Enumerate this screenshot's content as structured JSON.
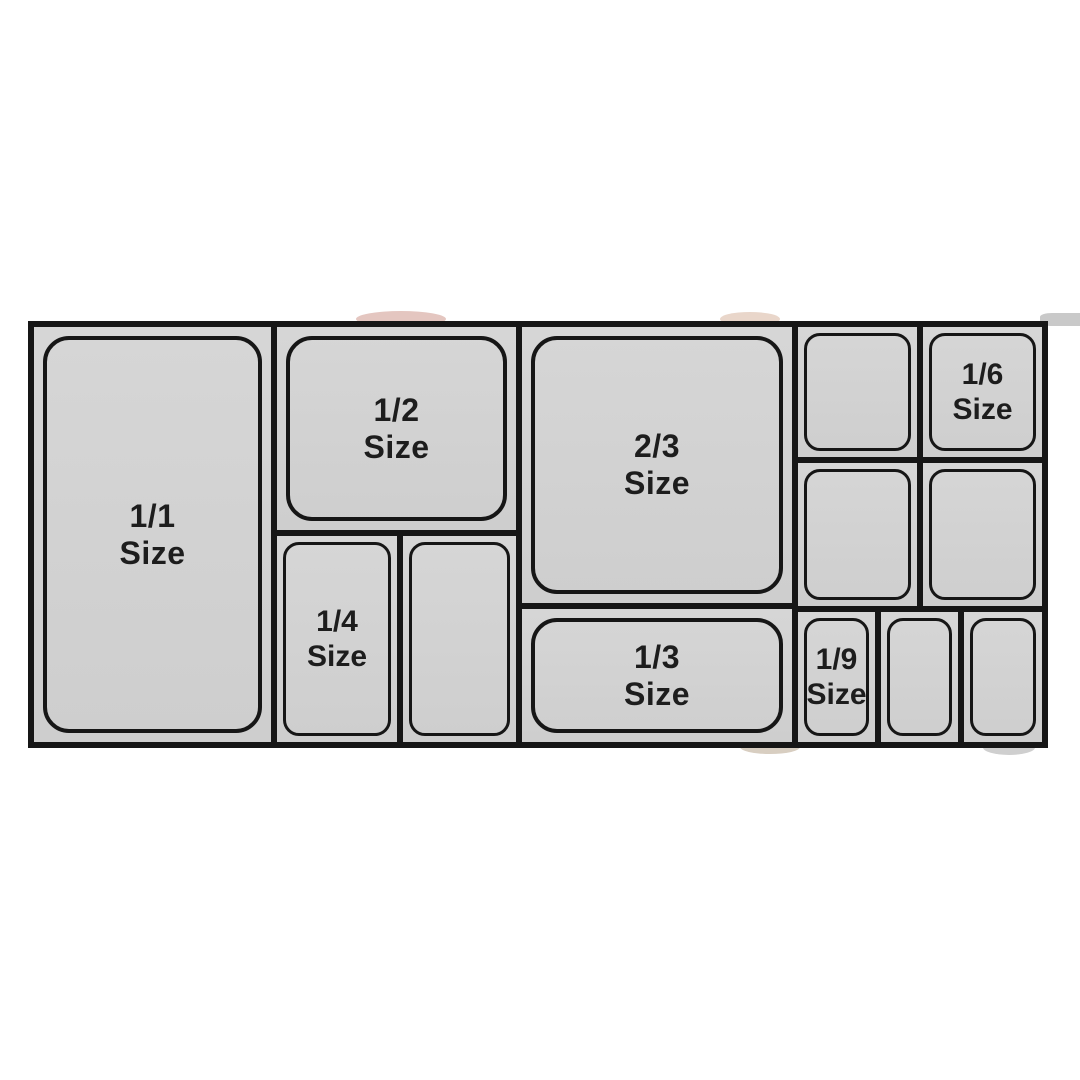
{
  "chart": {
    "pans": {
      "full": {
        "fraction": "1/1",
        "word": "Size"
      },
      "half": {
        "fraction": "1/2",
        "word": "Size"
      },
      "two_thirds": {
        "fraction": "2/3",
        "word": "Size"
      },
      "quarter": {
        "fraction": "1/4",
        "word": "Size"
      },
      "third": {
        "fraction": "1/3",
        "word": "Size"
      },
      "sixth": {
        "fraction": "1/6",
        "word": "Size"
      },
      "ninth": {
        "fraction": "1/9",
        "word": "Size"
      }
    },
    "unlabeled_pan_count": 6
  },
  "colors": {
    "background": "#ffffff",
    "grid_border": "#161616",
    "pan_fill_top": "#d6d6d6",
    "pan_fill_bottom": "#cecece",
    "label_text": "#1d1d1d"
  }
}
